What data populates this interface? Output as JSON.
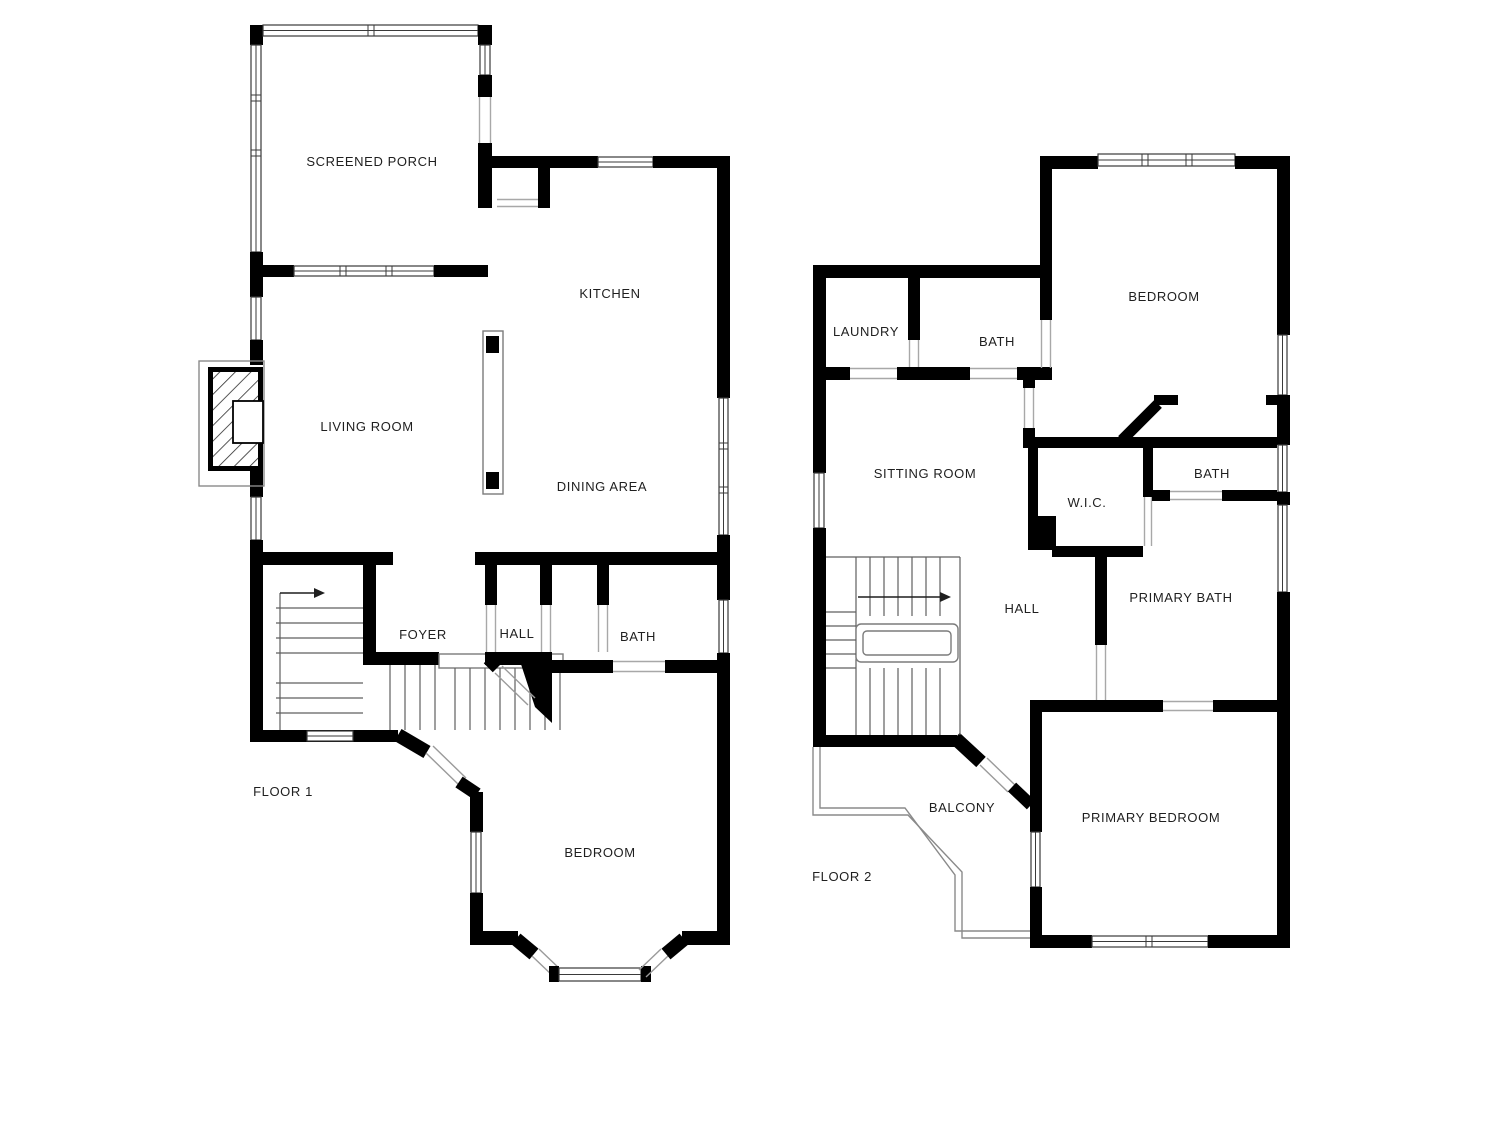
{
  "colors": {
    "wall": "#000000",
    "background": "#ffffff",
    "label": "#1f1f1f"
  },
  "floor1": {
    "label": "FLOOR 1",
    "rooms": {
      "screened_porch": "SCREENED PORCH",
      "kitchen": "KITCHEN",
      "living_room": "LIVING ROOM",
      "dining_area": "DINING AREA",
      "foyer": "FOYER",
      "hall": "HALL",
      "bath": "BATH",
      "bedroom": "BEDROOM"
    }
  },
  "floor2": {
    "label": "FLOOR 2",
    "rooms": {
      "laundry": "LAUNDRY",
      "bath_upper": "BATH",
      "bedroom": "BEDROOM",
      "sitting_room": "SITTING ROOM",
      "wic": "W.I.C.",
      "bath_right": "BATH",
      "hall": "HALL",
      "primary_bath": "PRIMARY BATH",
      "balcony": "BALCONY",
      "primary_bedroom": "PRIMARY BEDROOM"
    }
  }
}
